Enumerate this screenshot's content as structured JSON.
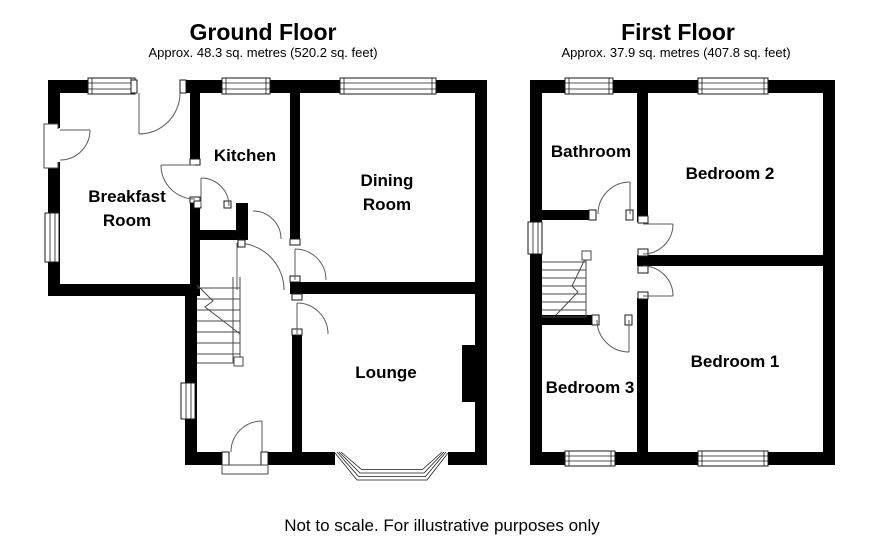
{
  "page": {
    "background": "#ffffff",
    "wall_color": "#000000",
    "line_color": "#5a5a5a",
    "text_color": "#000000"
  },
  "floors": [
    {
      "id": "ground-floor",
      "title": "Ground Floor",
      "area": "Approx. 48.3 sq. metres (520.2 sq. feet)",
      "rooms": [
        {
          "id": "breakfast-room",
          "lines": [
            "Breakfast",
            "Room"
          ]
        },
        {
          "id": "kitchen",
          "lines": [
            "Kitchen"
          ]
        },
        {
          "id": "dining-room",
          "lines": [
            "Dining",
            "Room"
          ]
        },
        {
          "id": "lounge",
          "lines": [
            "Lounge"
          ]
        }
      ],
      "features": [
        "staircase",
        "bay-window",
        "chimney-breast",
        "front-door-porch"
      ]
    },
    {
      "id": "first-floor",
      "title": "First Floor",
      "area": "Approx. 37.9 sq. metres (407.8 sq. feet)",
      "rooms": [
        {
          "id": "bathroom",
          "lines": [
            "Bathroom"
          ]
        },
        {
          "id": "bedroom-2",
          "lines": [
            "Bedroom 2"
          ]
        },
        {
          "id": "bedroom-1",
          "lines": [
            "Bedroom 1"
          ]
        },
        {
          "id": "bedroom-3",
          "lines": [
            "Bedroom 3"
          ]
        }
      ],
      "features": [
        "staircase",
        "landing"
      ]
    }
  ],
  "footer": {
    "note": "Not to scale. For illustrative purposes only"
  }
}
